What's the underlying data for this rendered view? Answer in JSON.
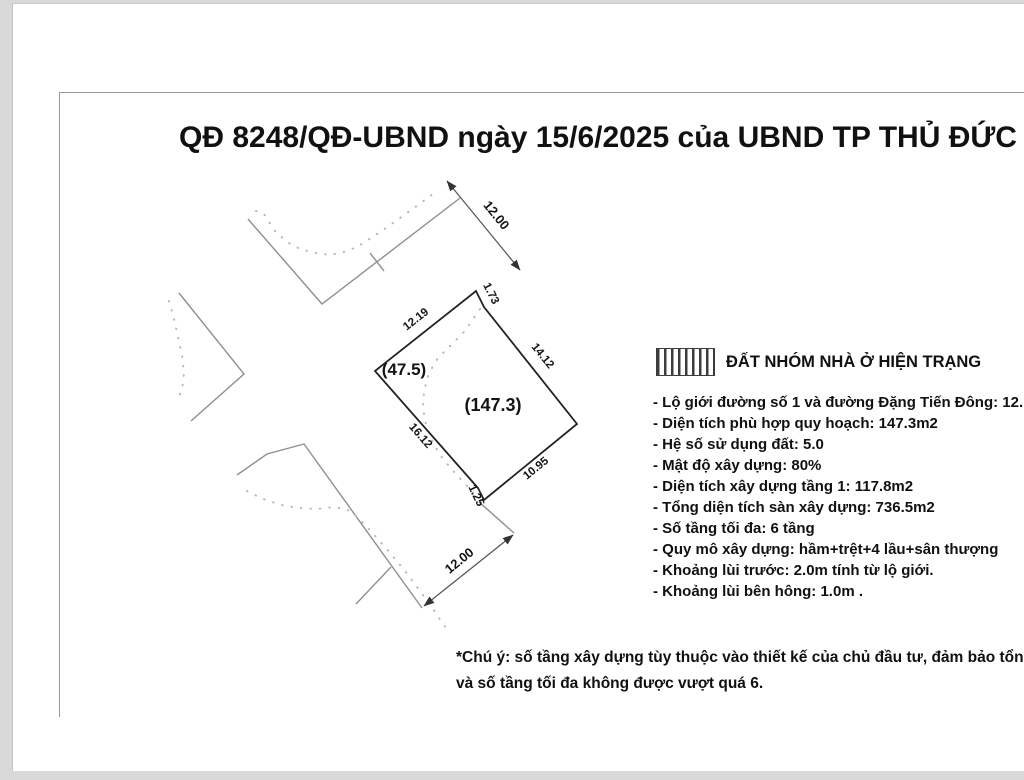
{
  "page": {
    "title": "QĐ 8248/QĐ-UBND ngày 15/6/2025 của UBND TP THỦ ĐỨC"
  },
  "legend": {
    "swatch": "vertical-hatch",
    "label": "ĐẤT NHÓM NHÀ Ở HIỆN TRẠNG"
  },
  "details": [
    "- Lộ giới đường số 1 và đường Đặng Tiến Đông: 12.",
    "- Diện tích phù hợp quy hoạch: 147.3m2",
    "- Hệ số sử dụng đất: 5.0",
    "- Mật độ xây dựng: 80%",
    "- Diện tích xây dựng tầng 1: 117.8m2",
    "- Tổng diện tích sàn xây dựng: 736.5m2",
    "- Số tầng tối đa: 6 tầng",
    "- Quy mô xây dựng: hầm+trệt+4 lầu+sân thượng",
    "- Khoảng lùi trước: 2.0m tính từ lộ giới.",
    "- Khoảng lùi bên hông: 1.0m ."
  ],
  "notes": [
    "*Chú ý: số tầng xây dựng tùy thuộc vào thiết kế của chủ đầu tư, đảm bảo  tổng",
    "và số tầng tối đa không được vượt quá 6."
  ],
  "diagram": {
    "parcel_edge_labels": {
      "nw": "12.19",
      "n": "1.73",
      "ne": "14.12",
      "se": "10.95",
      "s": "1.25",
      "sw": "16.12"
    },
    "area_labels": {
      "clipped": "(47.5)",
      "main": "(147.3)"
    },
    "road_dimensions": {
      "top": "12.00",
      "bottom": "12.00"
    },
    "colors": {
      "parcel_line": "#222222",
      "road_line": "#8f8f8f",
      "planned_boundary_dotted": "#b8b8b8",
      "dimension_line": "#555555"
    }
  }
}
